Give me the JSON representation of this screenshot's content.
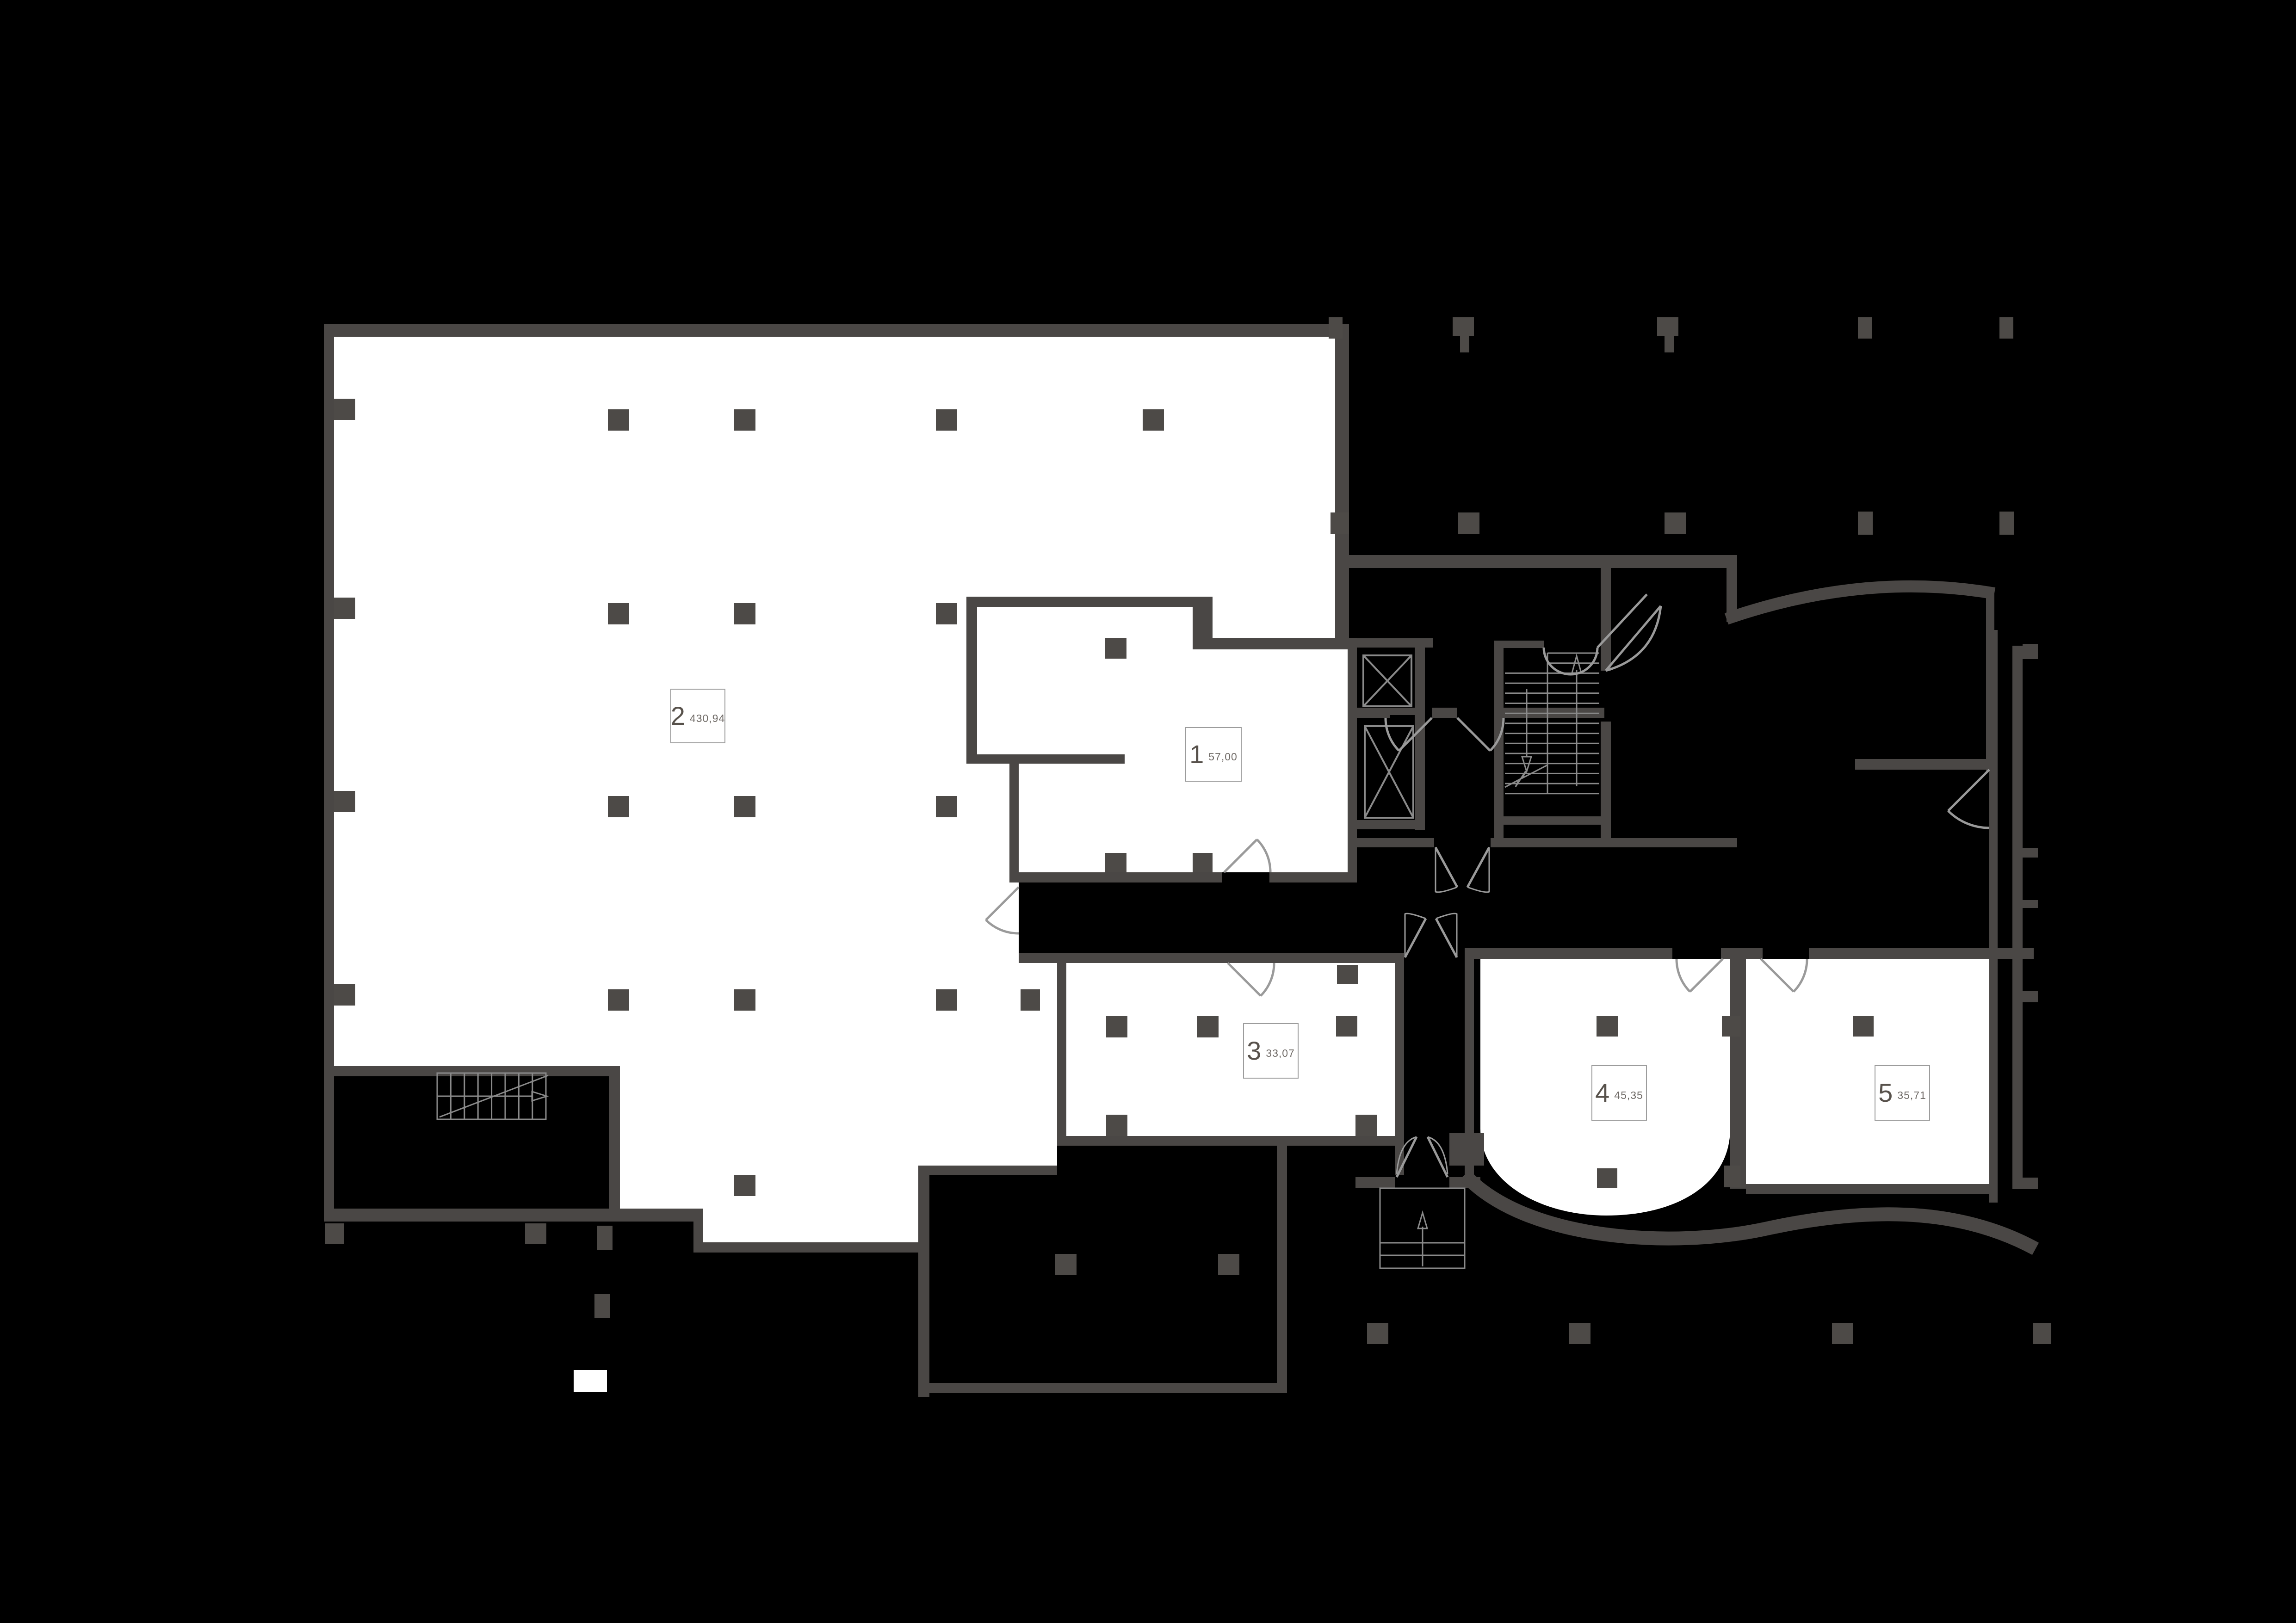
{
  "plan": {
    "type": "commercial-floor-plan",
    "background": "#000000"
  },
  "colors": {
    "background": "#000000",
    "wall": "#4a4745",
    "column": "#4d4a47",
    "room_fill": "#ffffff",
    "annotation_line_dark_bg": "#8a8a8a",
    "annotation_line_light_bg": "#9a9a9a",
    "label_border": "#9c9c9c",
    "label_number_text": "#57514b",
    "label_area_text": "#6f6a66"
  },
  "units": [
    {
      "number": "1",
      "area": "57,00"
    },
    {
      "number": "2",
      "area": "430,94"
    },
    {
      "number": "3",
      "area": "33,07"
    },
    {
      "number": "4",
      "area": "45,35"
    },
    {
      "number": "5",
      "area": "35,71"
    }
  ],
  "features": {
    "elevators": "two elevator shafts with X marks",
    "stairs": "main double-run stairwell, service stair in lower-left room, entrance porch steps",
    "doors": "swing arcs throughout"
  }
}
